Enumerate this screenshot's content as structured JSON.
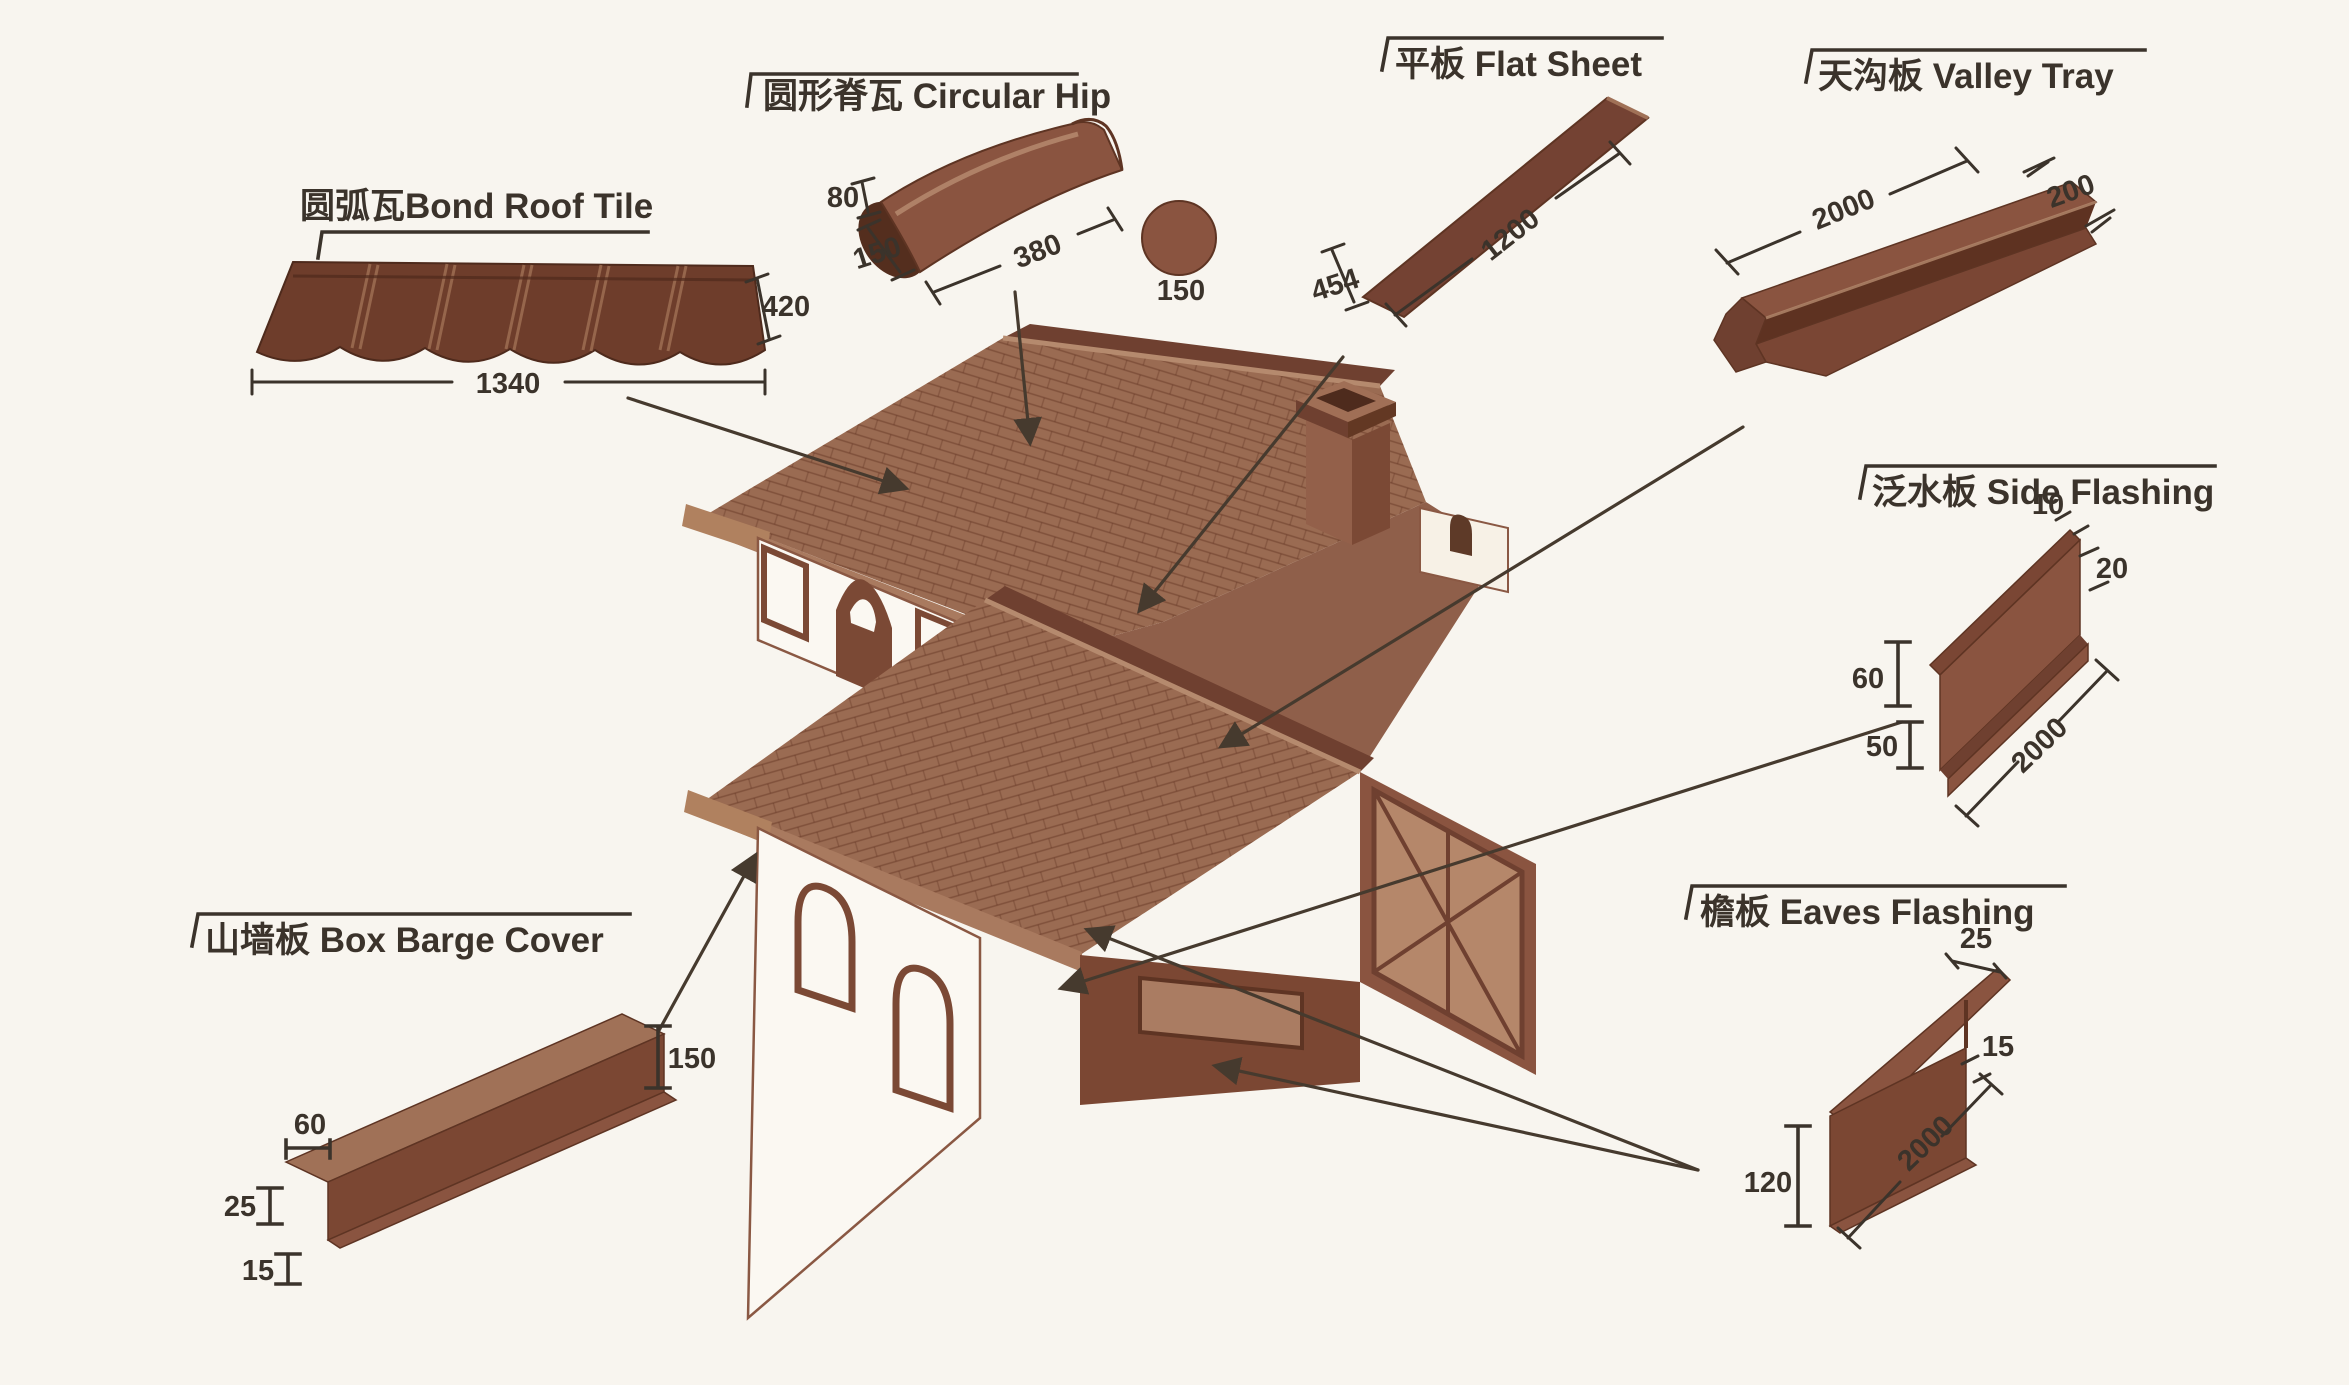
{
  "canvas": {
    "width": "2349",
    "height": "1385",
    "background": "#f8f5ef"
  },
  "colors": {
    "ink": "#3b332b",
    "leader": "#463a2e",
    "part_mid": "#8a5440",
    "part_dark": "#5e3221",
    "part_light": "#a07157",
    "roof": "#9a6b52",
    "roof_dark": "#6f4030",
    "wall_white": "#fbf8f2"
  },
  "parts": {
    "bond": {
      "label": "圆弧瓦Bond Roof Tile",
      "dim_length": "1340",
      "dim_height": "420"
    },
    "hip": {
      "label": "圆形脊瓦 Circular Hip",
      "dim_rise": "80",
      "dim_side": "150",
      "dim_length": "380",
      "dim_diameter": "150"
    },
    "flat": {
      "label": "平板 Flat Sheet",
      "dim_width": "454",
      "dim_length": "1200"
    },
    "valley": {
      "label": "天沟板 Valley Tray",
      "dim_length": "2000",
      "dim_width": "200"
    },
    "side": {
      "label": "泛水板 Side Flashing",
      "dim_top": "10",
      "dim_step": "20",
      "dim_upper": "60",
      "dim_lower": "50",
      "dim_length": "2000"
    },
    "barge": {
      "label": "山墙板 Box Barge Cover",
      "dim_top": "60",
      "dim_front": "25",
      "dim_lip": "15",
      "dim_height": "150"
    },
    "eaves": {
      "label": "檐板 Eaves Flashing",
      "dim_top": "25",
      "dim_step": "15",
      "dim_height": "120",
      "dim_length": "2000"
    }
  }
}
